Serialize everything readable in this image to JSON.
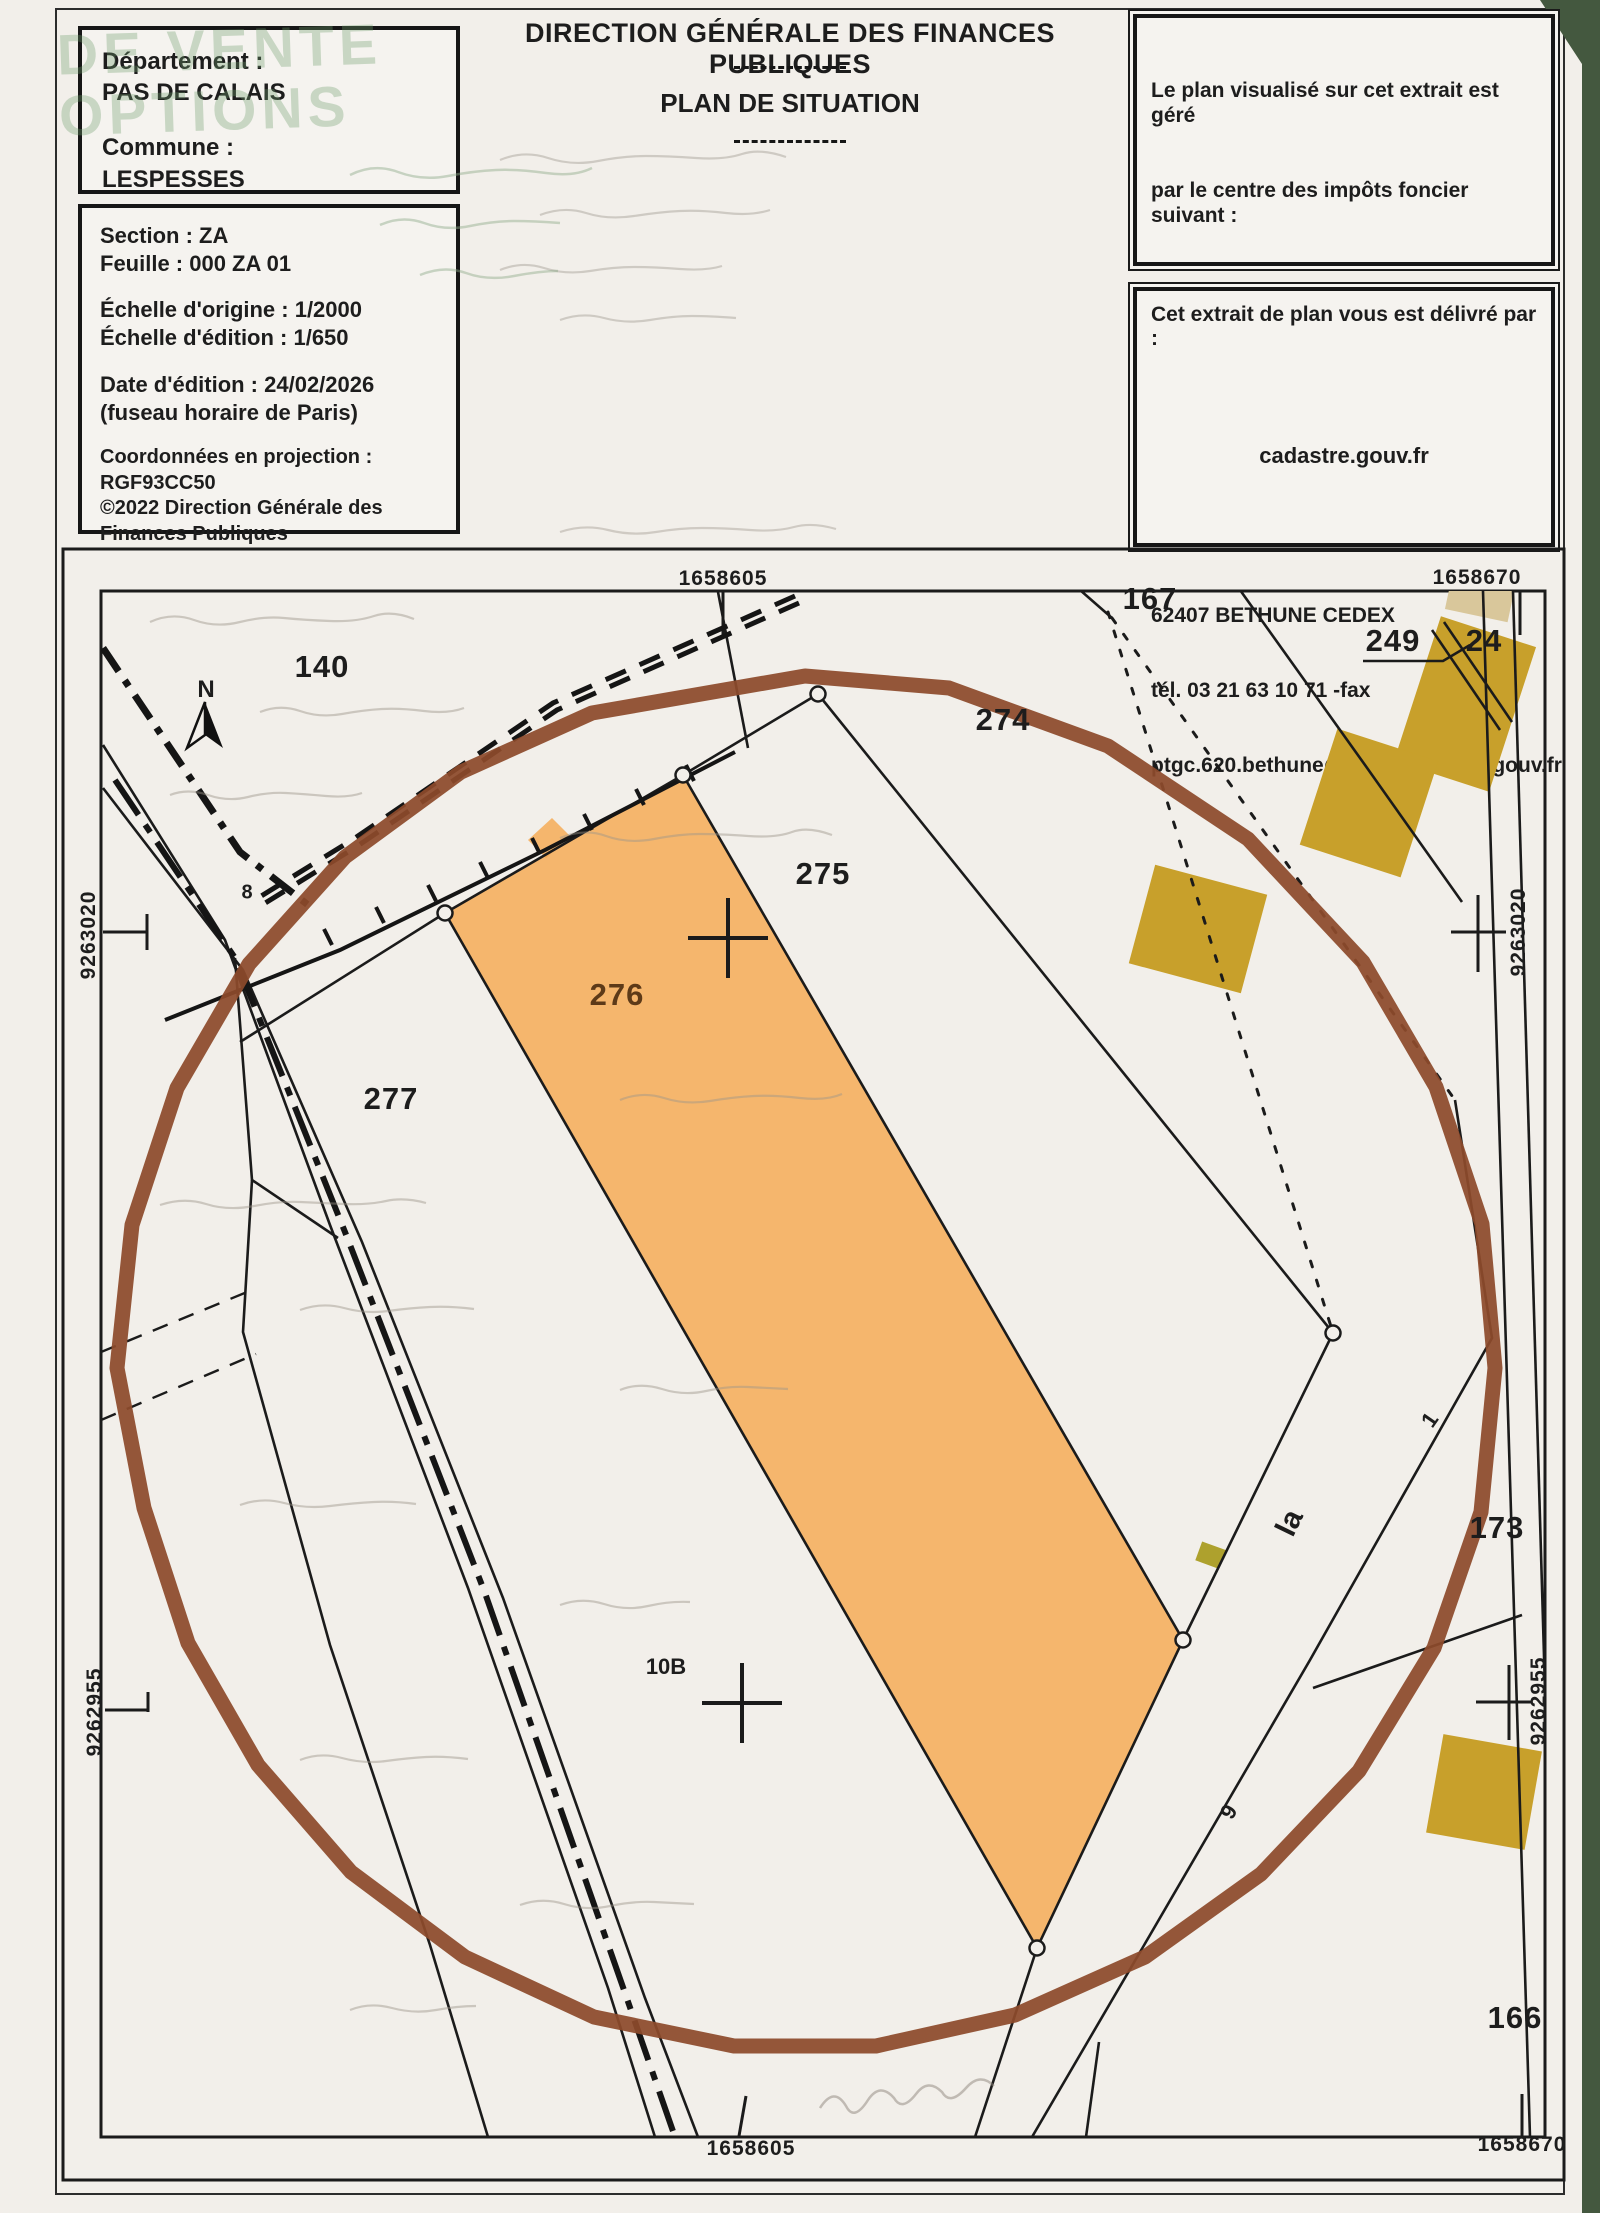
{
  "header": {
    "watermark_lines": [
      "DE VENTE",
      "OPTIONS"
    ],
    "dept_box": {
      "dept_label": "Département :",
      "dept_value": "PAS DE CALAIS",
      "commune_label": "Commune :",
      "commune_value": "LESPESSES"
    },
    "info_box": {
      "section": "Section : ZA",
      "sheet": "Feuille : 000 ZA 01",
      "scale_origin": "Échelle d'origine : 1/2000",
      "scale_edition": "Échelle d'édition : 1/650",
      "edition_date": "Date d'édition : 24/02/2026",
      "timezone": "(fuseau horaire de Paris)",
      "projection": "Coordonnées en projection : RGF93CC50",
      "copyright": "©2022 Direction Générale des Finances Publiques"
    },
    "title": "DIRECTION GÉNÉRALE DES FINANCES PUBLIQUES",
    "subtitle": "PLAN DE SITUATION",
    "office_box_lines": [
      "Le plan visualisé sur cet extrait est géré",
      "par le centre des impôts foncier suivant :",
      "BETHUNE",
      "  (Pôle de Topographie et de Gestion",
      "Cadastrale) 85, rue Georges Guynemer",
      "62407",
      "62407 BETHUNE CEDEX",
      "tél. 03 21 63 10 71 -fax",
      "ptgc.620.bethune@dgfip.finances.gouv.fr"
    ],
    "delivery_box": {
      "label": "Cet extrait de plan vous est délivré par :",
      "value": "cadastre.gouv.fr"
    }
  },
  "map": {
    "x_coordinates": {
      "top_left": "1658605",
      "top_right": "1658670",
      "bottom_left": "1658605",
      "bottom_right": "1658670"
    },
    "y_coordinates": {
      "upper": "9263020",
      "lower": "9262955"
    },
    "north_label": "N",
    "parcel_labels": [
      {
        "text": "140"
      },
      {
        "text": "167"
      },
      {
        "text": "249"
      },
      {
        "text": "24"
      },
      {
        "text": "274"
      },
      {
        "text": "275"
      },
      {
        "text": "276"
      },
      {
        "text": "277"
      },
      {
        "text": "173"
      },
      {
        "text": "166"
      }
    ],
    "small_labels": [
      {
        "text": "8"
      },
      {
        "text": "10B"
      },
      {
        "text": "la"
      },
      {
        "text": "1"
      },
      {
        "text": "9"
      }
    ],
    "colors": {
      "highlight": "#f5a74e",
      "building": "#c8a02b",
      "building_light": "#d9c79b",
      "small_building": "#aea12d",
      "circle": "#8d4a2b"
    }
  }
}
